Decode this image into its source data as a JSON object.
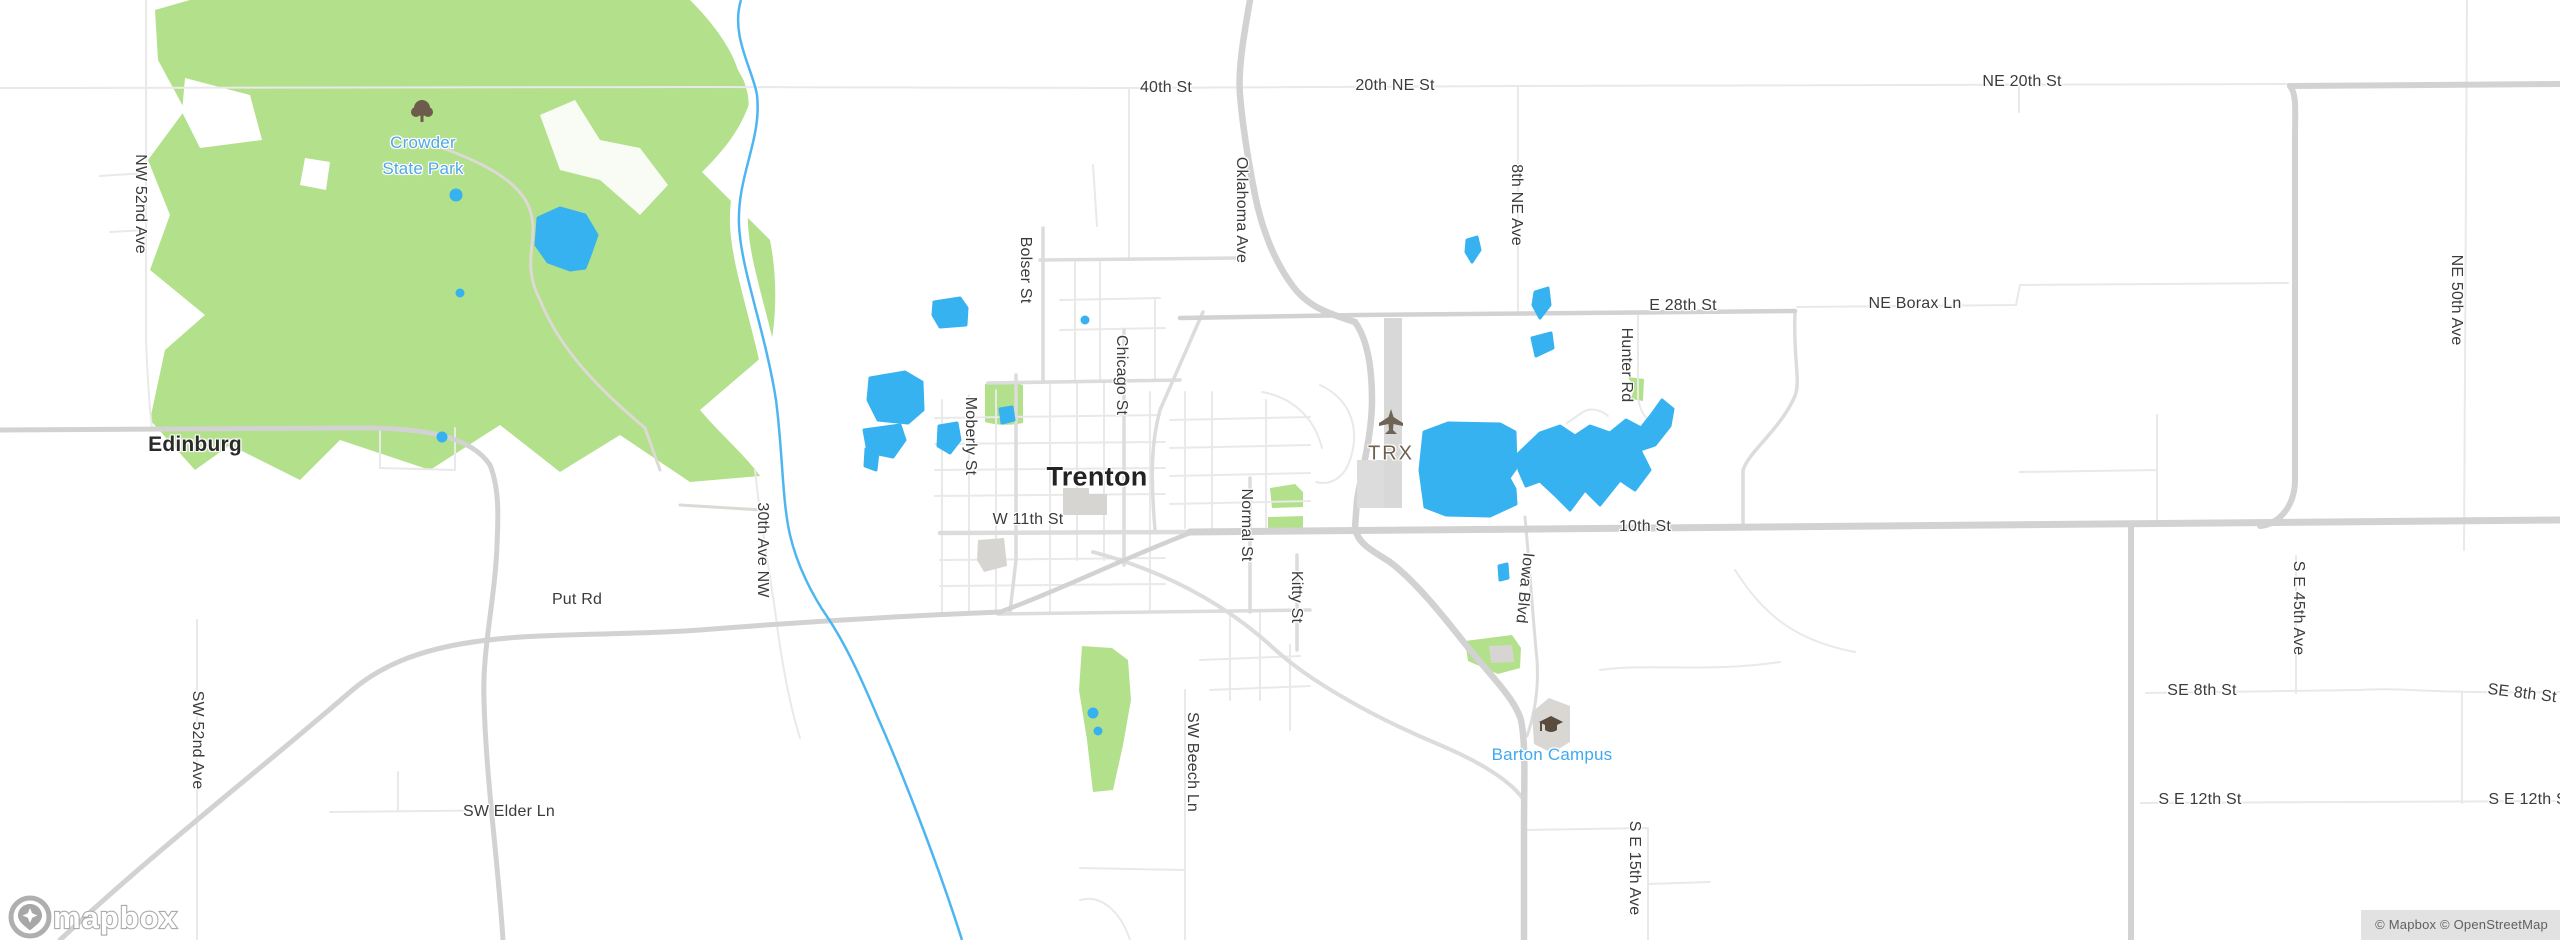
{
  "map": {
    "kind": "mapbox-street-map",
    "city": [
      {
        "text": "Trenton"
      },
      {
        "text": "Edinburg"
      }
    ],
    "pois": [
      {
        "text": "Crowder\nState Park"
      },
      {
        "text": "Barton Campus"
      },
      {
        "text": "TRX"
      }
    ],
    "streets_h": [
      {
        "text": "40th St"
      },
      {
        "text": "20th NE St"
      },
      {
        "text": "NE 20th St"
      },
      {
        "text": "E 28th St"
      },
      {
        "text": "NE Borax Ln"
      },
      {
        "text": "W 11th St"
      },
      {
        "text": "10th St"
      },
      {
        "text": "Put Rd"
      },
      {
        "text": "SW Elder Ln"
      },
      {
        "text": "SE 8th St"
      },
      {
        "text": "SE 8th St"
      },
      {
        "text": "S E 12th St"
      },
      {
        "text": "S E 12th St"
      }
    ],
    "streets_v": [
      {
        "text": "NW 52nd Ave"
      },
      {
        "text": "Oklahoma Ave"
      },
      {
        "text": "8th NE Ave"
      },
      {
        "text": "NE 50th Ave"
      },
      {
        "text": "Bolser St"
      },
      {
        "text": "Chicago St"
      },
      {
        "text": "Moberly St"
      },
      {
        "text": "Normal St"
      },
      {
        "text": "Kitty St"
      },
      {
        "text": "Hunter Rd"
      },
      {
        "text": "30th Ave NW"
      },
      {
        "text": "Iowa Blvd"
      },
      {
        "text": "SW 52nd Ave"
      },
      {
        "text": "SW Beech Ln"
      },
      {
        "text": "S E 45th Ave"
      },
      {
        "text": "S E 15th Ave"
      }
    ],
    "attribution": {
      "text": "© Mapbox © OpenStreetMap"
    },
    "logo": {
      "text": "mapbox"
    },
    "icons": {
      "park": "tree-icon",
      "airport": "airplane-icon",
      "college": "graduation-cap-icon",
      "watermark": "mapbox-pin-icon"
    },
    "colors": {
      "water": "#36b2f1",
      "river": "#4db6f0",
      "park_green": "#b3e08a",
      "road_major": "#d2d2d2",
      "road_medium": "#dcdcdc",
      "road_minor": "#e9e9e9",
      "building": "#d7d5d2",
      "label_dark": "#3b3b3b",
      "poi_blue": "#3fa9f0",
      "park_blue": "#4fa9e4",
      "airport_brown": "#6f6150"
    }
  }
}
